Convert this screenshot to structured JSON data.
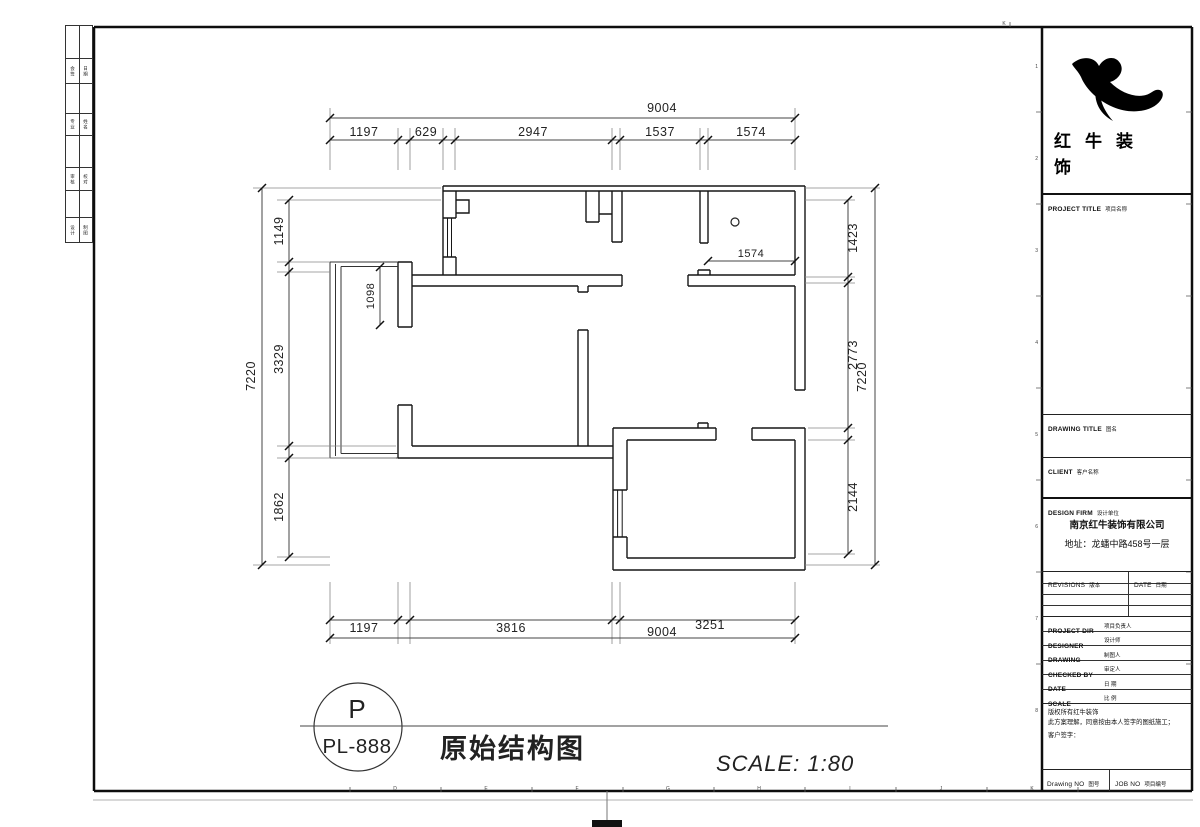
{
  "sheet": {
    "stamp": {
      "tag": "P",
      "code": "PL-888",
      "drawing_title": "原始结构图",
      "scale_label": "SCALE: 1:80"
    },
    "brand": {
      "line1": "红牛装",
      "line2": "饰"
    },
    "title_block": {
      "project_title_en": "PROJECT TITLE",
      "project_title_cn": "项目名称",
      "drawing_title_en": "DRAWING TITLE",
      "drawing_title_cn": "图名",
      "client_en": "CLIENT",
      "client_cn": "客户名称",
      "design_firm_en": "DESIGN FIRM",
      "design_firm_cn": "设计单位",
      "company": "南京红牛装饰有限公司",
      "address": "地址：龙蟠中路458号一层",
      "revisions_en": "REVISIONS",
      "revisions_cn": "版本",
      "date_hdr_en": "DATE",
      "date_hdr_cn": "日期",
      "rows": [
        {
          "en": "PROJECT DIR",
          "cn": "项目负责人"
        },
        {
          "en": "DESIGNER",
          "cn": "设计师"
        },
        {
          "en": "DRAWING",
          "cn": "制图人"
        },
        {
          "en": "CHECKED BY",
          "cn": "审定人"
        },
        {
          "en": "DATE",
          "cn": "日 期"
        },
        {
          "en": "SCALE",
          "cn": "比 例"
        }
      ],
      "copyright_line1": "版权所有红牛装饰",
      "copyright_line2": "此方案理解，同意按由本人签字的图纸施工；",
      "copyright_line3": "客户签字：",
      "drawing_no_en": "Drawing NO",
      "drawing_no_cn": "图号",
      "job_no_en": "JOB NO",
      "job_no_cn": "项目编号"
    },
    "side_strip": [
      [
        "会签",
        "日期"
      ],
      [
        "专业",
        "姓名"
      ],
      [
        "审核",
        "校对"
      ],
      [
        "设计",
        "制图"
      ]
    ],
    "ruler": {
      "bottom_letters": [
        "D",
        "E",
        "F",
        "G",
        "H",
        "I",
        "J",
        "K"
      ],
      "right_numbers": [
        "1",
        "2",
        "3",
        "4",
        "5",
        "6",
        "7",
        "8"
      ],
      "top_letter": "K"
    }
  },
  "dims": {
    "top": {
      "overall": "9004",
      "seg": [
        "1197",
        "629",
        "2947",
        "1537",
        "1574"
      ]
    },
    "bottom": {
      "overall": "9004",
      "seg": [
        "1197",
        "3816",
        "3251"
      ]
    },
    "left": {
      "overall": "7220",
      "seg": [
        "1149",
        "3329",
        "1862"
      ]
    },
    "right": {
      "overall": "7220",
      "seg": [
        "1423",
        "2773",
        "2144"
      ]
    },
    "inner": {
      "v": "1098",
      "h": "1574"
    }
  }
}
